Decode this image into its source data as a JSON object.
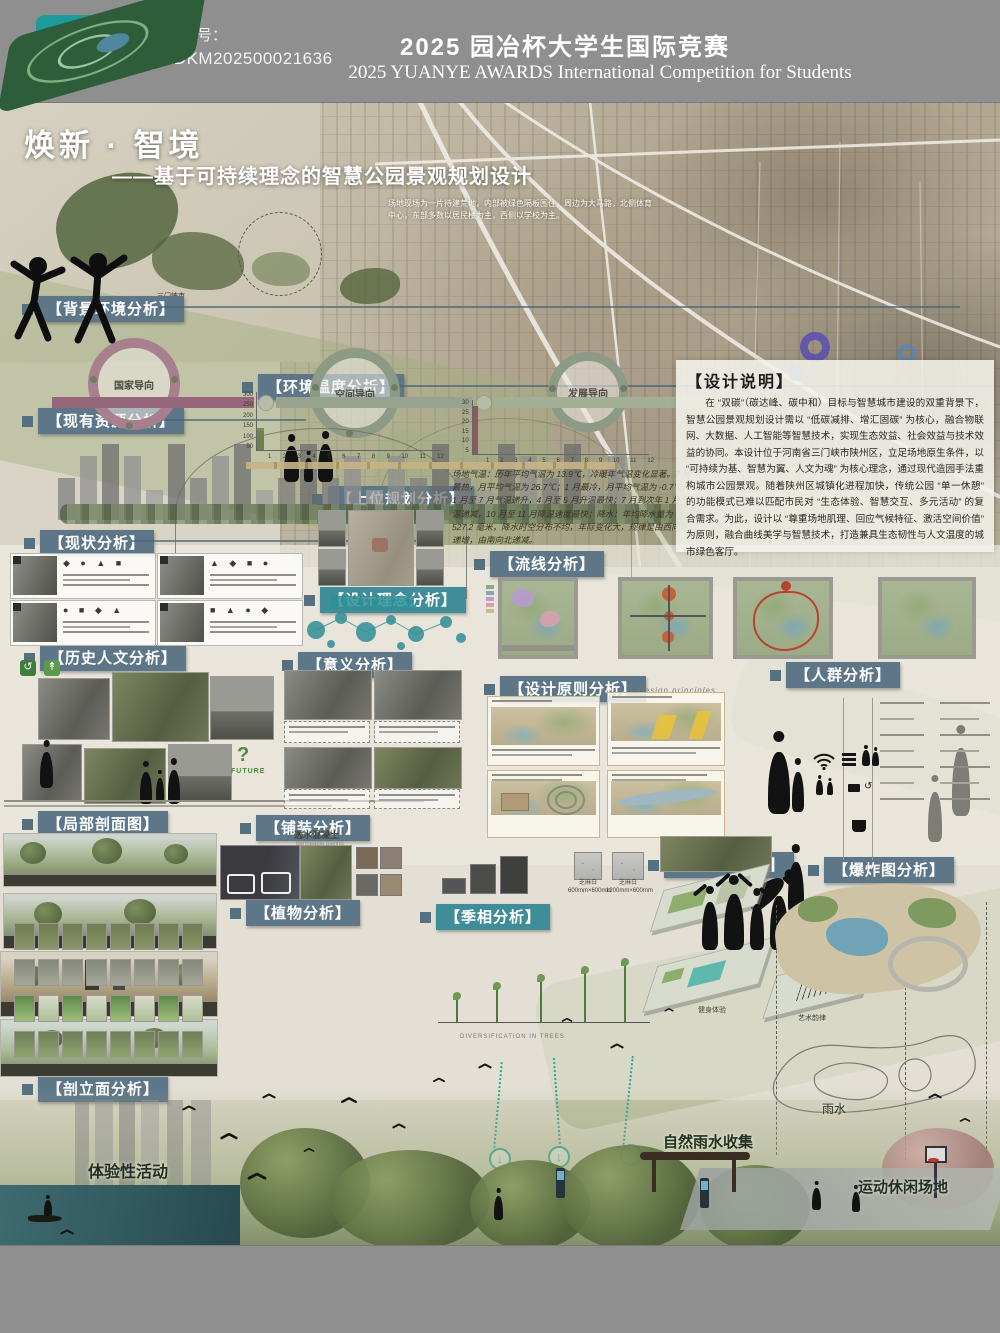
{
  "header": {
    "logo": {
      "glyph": "y",
      "line1": "YUANYE",
      "line2": "AWARDS",
      "cn": "园 冶 杯"
    },
    "reg_label": "报名序号：",
    "reg_number": "LADKM202500021636",
    "title_cn": "2025 园冶杯大学生国际竞赛",
    "title_en": "2025 YUANYE AWARDS International Competition for  Students"
  },
  "hero": {
    "title": "焕新 · 智境",
    "subtitle": "——基于可持续理念的智慧公园景观规划设计",
    "site_note": "场地现场为一片待建荒地，内部被绿色隔板围住，周边为大马路，北侧体育中心，东部多数以居民楼为主，西侧以学校为主。",
    "city_label": "三门峡市"
  },
  "sections": {
    "background": "【背景环境分析】",
    "temperature": "【环境温度分析】",
    "resources": "【现有资源分析】",
    "upper_plan": "【上位规划分析】",
    "status": "【现状分析】",
    "circulation": "【流线分析】",
    "concept": "【设计理念分析】",
    "history": "【历史人文分析】",
    "meaning": "【意义分析】",
    "principles": "【设计原则分析】",
    "crowd": "【人群分析】",
    "partial_section": "【局部剖面图】",
    "paving": "【铺装分析】",
    "nodes": "【小节点分析】",
    "explode": "【爆炸图分析】",
    "plants": "【植物分析】",
    "seasons": "【季相分析】",
    "elevation": "【剖立面分析】"
  },
  "design_note": {
    "heading": "【设计说明】",
    "body": "在 “双碳”（碳达峰、碳中和）目标与智慧城市建设的双重背景下，智慧公园景观规划设计需以 “低碳减排、增汇固碳” 为核心，融合物联网、大数据、人工智能等智慧技术，实现生态效益、社会效益与技术效益的协同。本设计位于河南省三门峡市陕州区，立足场地原生条件，以 “可持续为基、智慧为翼、人文为魂” 为核心理念，通过现代造园手法重构城市公园景观。随着陕州区城镇化进程加快，传统公园 “单一休憩” 的功能模式已难以匹配市民对 “生态体验、智慧交互、多元活动” 的复合需求。为此，设计以 “尊重场地肌理、回应气候特征、激活空间价值” 为原则，融合曲线美学与智慧技术，打造兼具生态韧性与人文温度的城市绿色客厅。"
  },
  "rings": {
    "r1": "国家导向",
    "r2": "空间导向",
    "r3": "发展导向"
  },
  "climate": {
    "body": "场地气温：历年平均气温为 13.9℃，冷暖年气温变化显著。7 月最热，月平均气温为 26.7℃；1 月最冷，月平均气温为 -0.7℃。1 月至 7 月气温递升，4 月至 5 月升温最快；7 月到次年 1 月气温递减，10 月至 11 月降温速度最快；降水：年均降水量为 527.2 毫米，降水时空分布不均，年际变化大，规律是由西向东递增，由南向北递减。"
  },
  "charts": {
    "months": [
      "1",
      "2",
      "3",
      "4",
      "5",
      "6",
      "7",
      "8",
      "9",
      "10",
      "11",
      "12"
    ],
    "precipitation": {
      "type": "bar",
      "unit": "mm",
      "ticks": [
        "300",
        "250",
        "200",
        "150",
        "100",
        "50"
      ],
      "values": [
        4,
        8,
        16,
        32,
        48,
        60,
        112,
        98,
        76,
        44,
        20,
        9
      ],
      "ylim": [
        0,
        300
      ]
    },
    "temperature": {
      "type": "bar",
      "unit": "℃",
      "ticks": [
        "30",
        "25",
        "20",
        "15",
        "10",
        "5"
      ],
      "values": [
        -0.7,
        2.1,
        7.8,
        14.2,
        19.6,
        24.1,
        26.7,
        25.3,
        20.1,
        13.8,
        6.9,
        1.2
      ],
      "ylim": [
        0,
        30
      ]
    }
  },
  "principles": {
    "note_en": "Design principles"
  },
  "history": {
    "question": "?",
    "future": "FUTURE"
  },
  "paving": {
    "material": "透水混凝土",
    "material_en": "permeable paving",
    "stones": [
      {
        "name": "芝麻白",
        "size": "600mm×600mm"
      },
      {
        "name": "芝麻白",
        "size": "1200mm×600mm"
      }
    ]
  },
  "nodes": {
    "labels": [
      "健康生活",
      "健身体验",
      "艺术韵律"
    ]
  },
  "seasons": {
    "caption": "DIVERSIFICATION IN TREES"
  },
  "annotations": {
    "experience": "体验性活动",
    "rain": "雨水",
    "rain_collect": "自然雨水收集",
    "sport": "运动休闲场地"
  },
  "icons": {
    "down_arrow": "↓"
  }
}
